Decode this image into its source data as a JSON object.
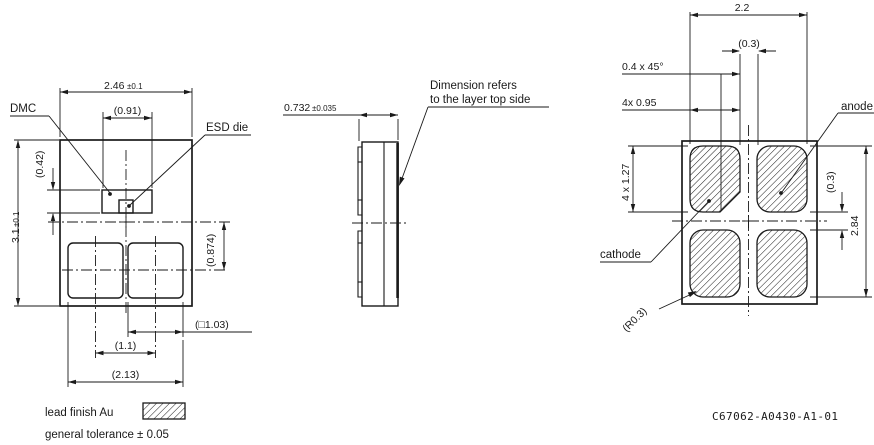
{
  "front": {
    "labels": {
      "dmc": "DMC",
      "esd": "ESD die"
    },
    "dims": {
      "width": "2.46",
      "width_tol": "±0.1",
      "dmc_width": "(0.91)",
      "dmc_height": "(0.42)",
      "height": "3.1",
      "height_tol": "±0.1",
      "pad_offset": "(0.874)",
      "pad_square": "(□1.03)",
      "pad_pitch": "(1.1)",
      "pad_span": "(2.13)"
    }
  },
  "side": {
    "dims": {
      "thickness": "0.732",
      "thickness_tol": "±0.035"
    },
    "note_line1": "Dimension refers",
    "note_line2": "to the layer top side"
  },
  "bottom": {
    "labels": {
      "anode": "anode",
      "cathode": "cathode"
    },
    "dims": {
      "pad_span_h": "2.2",
      "pad_gap_h": "(0.3)",
      "chamfer": "0.4 x 45°",
      "pad_width": "4x 0.95",
      "pad_height": "4 x 1.27",
      "pad_gap_v": "(0.3)",
      "pad_span_v": "2.84",
      "corner_radius": "(R0.3)"
    }
  },
  "legend": {
    "lead_finish": "lead finish Au",
    "general_tolerance": "general tolerance ± 0.05"
  },
  "doc_number": "C67062-A0430-A1-01",
  "colors": {
    "line": "#1a1a1a",
    "background": "#ffffff"
  }
}
